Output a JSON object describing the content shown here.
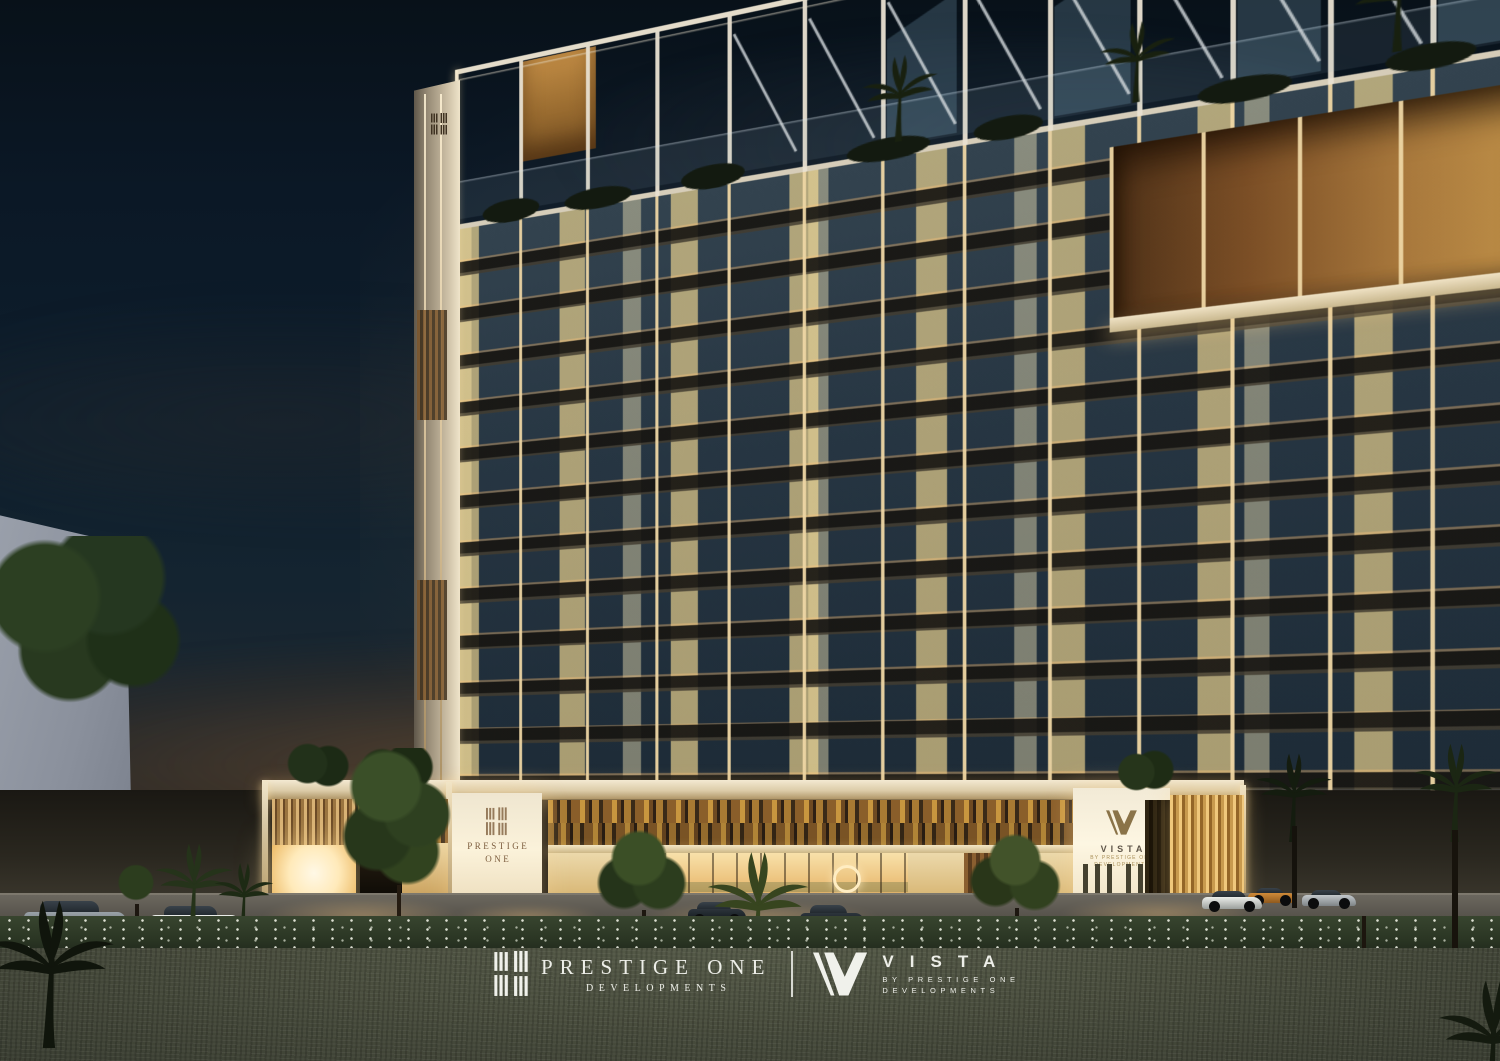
{
  "branding": {
    "developer": {
      "name": "PRESTIGE ONE",
      "division": "DEVELOPMENTS"
    },
    "project": {
      "name": "VISTA",
      "byline_line1": "BY PRESTIGE ONE",
      "byline_line2": "DEVELOPMENTS"
    }
  },
  "building_signage": {
    "podium_left": {
      "line1": "PRESTIGE",
      "line2": "ONE"
    },
    "podium_right": {
      "name": "VISTA",
      "sub_line1": "BY PRESTIGE ONE",
      "sub_line2": "DEVELOPMENTS"
    }
  },
  "colors": {
    "sky_top": "#0a1520",
    "horizon_glow": "#7a5430",
    "frame_white": "#e4dac4",
    "warm_light": "#f6d79a",
    "facade_glass": "#263542",
    "wood_accent": "#9a6b38",
    "grass": "#4a4e3e"
  }
}
